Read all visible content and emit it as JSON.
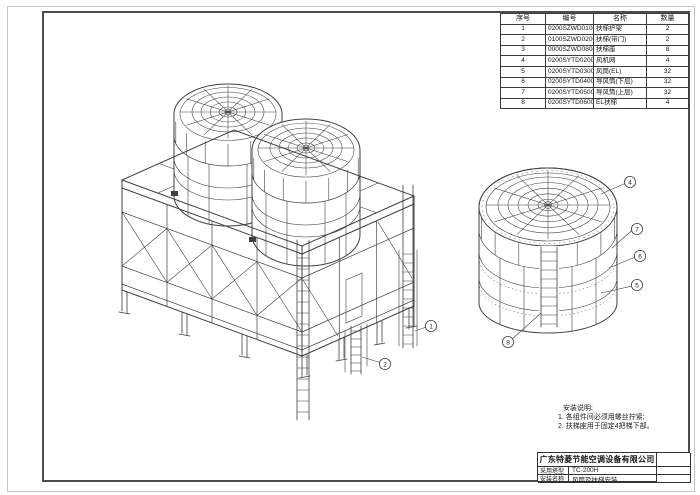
{
  "sheet": {
    "paper_color": "#ffffff",
    "line_color": "#3f3f3f",
    "border_color": "#4c4c4c"
  },
  "parts_table": {
    "headers": [
      "序号",
      "编号",
      "名称",
      "数量"
    ],
    "rows": [
      [
        "1",
        "0200SZWD0100",
        "扶梯护架",
        "2"
      ],
      [
        "2",
        "0100SZWD0200",
        "扶梯(带门)",
        "2"
      ],
      [
        "3",
        "0000SZWD0800",
        "扶梯座",
        "8"
      ],
      [
        "4",
        "0200SYTD0200",
        "风机网",
        "4"
      ],
      [
        "5",
        "0200SYTD0300",
        "风筒(EL)",
        "32"
      ],
      [
        "6",
        "0200SYTD0400",
        "导风筒(下层)",
        "32"
      ],
      [
        "7",
        "0200SYTD0500",
        "导风筒(上层)",
        "32"
      ],
      [
        "8",
        "0200SYTD0600",
        "EL扶梯",
        "4"
      ]
    ]
  },
  "callouts": {
    "main": [
      "1",
      "2"
    ],
    "detail": [
      "4",
      "7",
      "6",
      "5",
      "8"
    ]
  },
  "notes": {
    "title": "安装说明:",
    "line1": "1. 各组件间必须用螺丝拧紧;",
    "line2": "2. 扶梯座用于固定4把梯下部。"
  },
  "title_block": {
    "company": "广东特菱节能空调设备有限公司",
    "row1_label": "采用塔型",
    "row1_value": "TC-200H",
    "row2_label": "安装名称",
    "row2_value": "风筒及扶梯安装"
  }
}
